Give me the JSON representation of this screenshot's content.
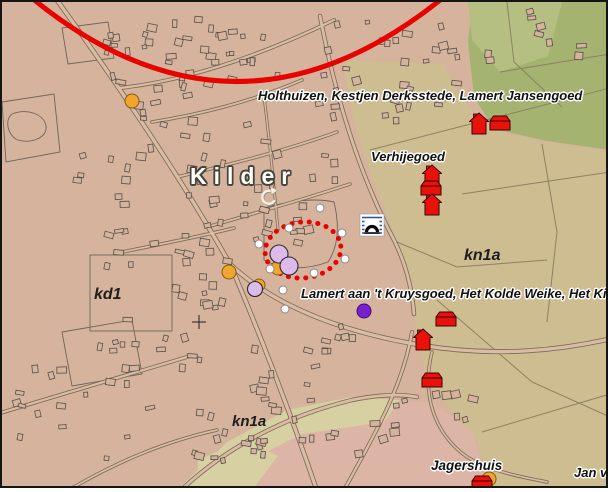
{
  "map": {
    "title_label": "Kilder",
    "farm_labels": {
      "holthuizen": "Holthuizen, Kestjen Derksstede, Lamert Jansengoed",
      "verhijegoed": "Verhijegoed",
      "kruysgoed": "Lamert aan 't Kruysgoed, Het Kolde Weike, Het Kilderhu",
      "jagershuis": "Jagershuis",
      "jan_van": "Jan va"
    },
    "area_codes": {
      "kd1": "kd1",
      "kn1a_east": "kn1a",
      "kn1a_south": "kn1a"
    },
    "icons": {
      "monument": "arch-monument-icon",
      "rotation": "rotate-clockwise-icon",
      "cross": "plus-cross-icon"
    },
    "colors": {
      "urban": "#d6b39c",
      "road_fill": "#dabca4",
      "field": "#cdbd90",
      "green": "#a4b370",
      "green_light": "#b6bf82",
      "pink": "#ddb5a6",
      "pale_band": "#d6d0a2",
      "red": "#e60300",
      "building_red": "#e8120a",
      "orange": "#f2a52c",
      "lavender": "#dcbbec",
      "purple": "#7a1ed2",
      "white_dot": "#ffffff"
    },
    "markers": {
      "white_dots": [
        [
          318,
          206
        ],
        [
          287,
          226
        ],
        [
          257,
          242
        ],
        [
          340,
          231
        ],
        [
          343,
          257
        ],
        [
          268,
          267
        ],
        [
          312,
          271
        ],
        [
          281,
          288
        ],
        [
          283,
          307
        ]
      ],
      "orange_dots": [
        {
          "x": 130,
          "y": 99,
          "r": 7
        },
        {
          "x": 227,
          "y": 270,
          "r": 7
        },
        {
          "x": 276,
          "y": 266,
          "r": 7
        },
        {
          "x": 257,
          "y": 283,
          "r": 6
        },
        {
          "x": 487,
          "y": 477,
          "r": 7
        }
      ],
      "lavender_dots": [
        {
          "x": 277,
          "y": 252,
          "r": 9
        },
        {
          "x": 287,
          "y": 264,
          "r": 9
        },
        {
          "x": 253,
          "y": 287,
          "r": 7.5
        }
      ],
      "purple_dots": [
        {
          "x": 362,
          "y": 309,
          "r": 7
        }
      ],
      "red_buildings": [
        {
          "t": "house",
          "x": 477,
          "y": 122
        },
        {
          "t": "barn",
          "x": 498,
          "y": 121
        },
        {
          "t": "house",
          "x": 430,
          "y": 174
        },
        {
          "t": "barn",
          "x": 429,
          "y": 186
        },
        {
          "t": "house",
          "x": 430,
          "y": 203
        },
        {
          "t": "barn",
          "x": 444,
          "y": 317
        },
        {
          "t": "house",
          "x": 421,
          "y": 338
        },
        {
          "t": "barn",
          "x": 430,
          "y": 378
        },
        {
          "t": "barn",
          "x": 480,
          "y": 481
        }
      ],
      "red_range_arc": true,
      "red_dotted_ellipse": {
        "cx": 301,
        "cy": 248,
        "rx": 38,
        "ry": 28
      }
    }
  }
}
